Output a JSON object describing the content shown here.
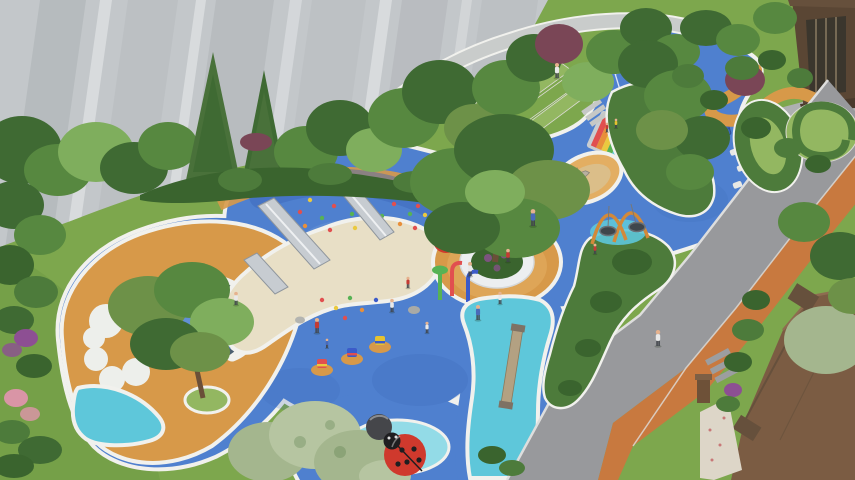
{
  "image": {
    "type": "aerial-3d-architectural-render",
    "subject": "residential children's playground landscape",
    "width_px": 855,
    "height_px": 480
  },
  "scene": {
    "setting": "bird's-eye rendering of a courtyard playground between apartment buildings",
    "areas": {
      "apartment_facade": "gray high-rise wall with vertical panels, top left",
      "tree_buffer": "dense tree and shrub band along the building",
      "lawns": "green lawns on the left, right and bottom",
      "play_surface": "organic blue rubber play surface with white borders",
      "orange_swirl": "orange rubber surround on left lobe and central tree ring",
      "sand_area": "kidney shaped sand pit with embankment slides",
      "terraced_lawn": "stepped turf terraces at top center",
      "cyan_stream": "light blue stream-like path with a balance beam",
      "access_road": "gray road with orange jogging strip on the right",
      "entrance_building": "brown lobby entrance, top right",
      "roof": "brown building roof, bottom right corner"
    },
    "equipment": [
      "embankment slides",
      "climbing dot holds",
      "nest swings with orange arches",
      "rainbow climbing mat",
      "in-ground trampoline",
      "mini sports court markings",
      "spring riders",
      "water play posts",
      "ladybug sculptures",
      "strawberry sculpture",
      "balance beam",
      "sand play boat"
    ],
    "figures": {
      "people_visible": 16
    }
  },
  "palette": {
    "facade": "#c3c7ca",
    "facade_dark": "#a7acb0",
    "facade_light": "#d8dbdd",
    "plaza": "#aeb0b1",
    "road": "#98999c",
    "road_edge": "#dededd",
    "track": "#c8793f",
    "roof": "#7b5c43",
    "roof_dark": "#66503c",
    "entrance": "#5a4634",
    "glass": "#3b362d",
    "lawn": "#7da74d",
    "lawn_light": "#93b761",
    "lawn_dark": "#5f8a3a",
    "hedge": "#4d7b3b",
    "hedge_dark": "#3a642e",
    "tree": "#578840",
    "tree_light": "#7fae5d",
    "tree_dark": "#3f6a33",
    "tree_pale": "#a4b68e",
    "tree_pale2": "#b6c5a1",
    "olive": "#6d9148",
    "conifer": "#49713a",
    "purple_tree": "#7a4656",
    "purple_flower": "#8d4f93",
    "pink_flower": "#d995a6",
    "blue": "#4f80cf",
    "blue_light": "#7ba3e0",
    "blue_dark": "#3b67b8",
    "cyan": "#5ec7da",
    "cyan_light": "#93dbe7",
    "orange": "#d79949",
    "orange_light": "#e3ae62",
    "sand": "#e8dfc6",
    "sand_dark": "#d6c8a4",
    "border_white": "#f1f1ed",
    "cloud": "#edefeb",
    "spike": "#4b5f70",
    "metal": "#c7ccd1",
    "metal_dark": "#8f969d",
    "red": "#cf392d",
    "dark": "#3b3b3e",
    "swing": "#d2893a",
    "wood": "#b3a182",
    "wood_dark": "#8a7a5c",
    "hold_red": "#e14f4f",
    "hold_yellow": "#eac93f",
    "hold_green": "#57b254",
    "hold_orange": "#e88f3a",
    "rider_blue": "#3c5bc9",
    "rider_yellow": "#e6c22f",
    "skin": "#e6b28e",
    "shirt_white": "#e9e9e9",
    "shirt_red": "#c43b34",
    "shirt_blue": "#4a6ab8",
    "pants": "#41454b",
    "paver": "#ddd6c8",
    "trunk": "#6a4f38"
  }
}
